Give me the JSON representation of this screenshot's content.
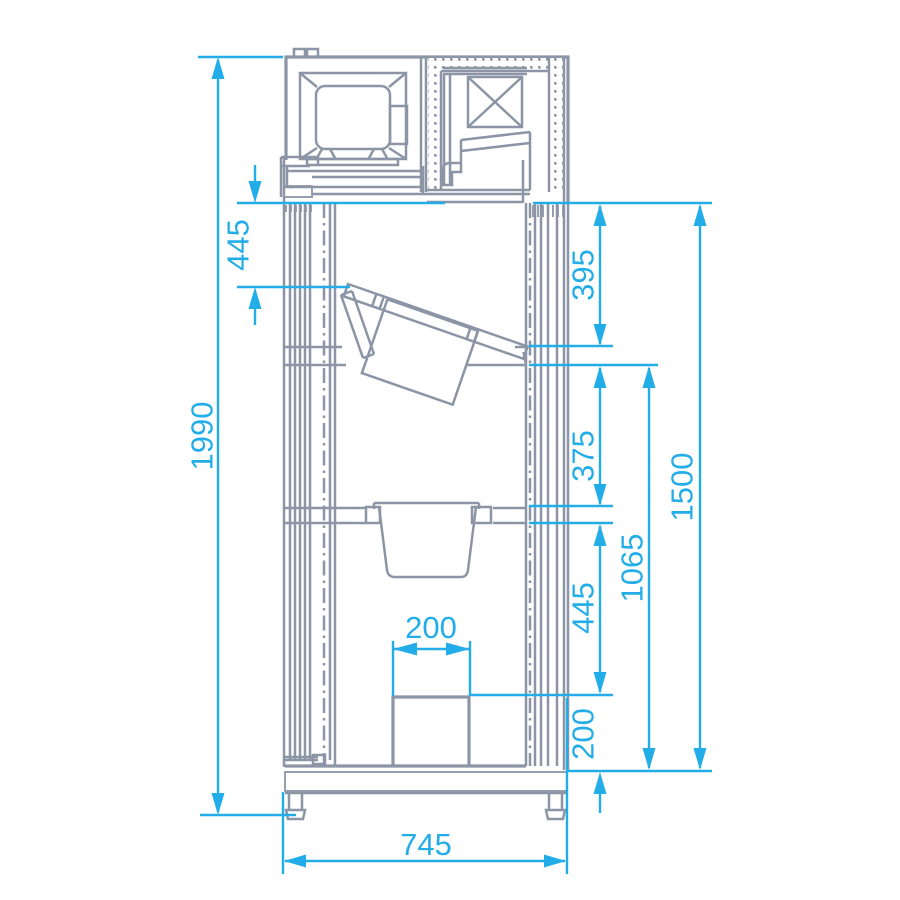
{
  "drawing": {
    "title": "refrigerated-cabinet-cross-section",
    "colors": {
      "background": "#ffffff",
      "structure_line": "#8b95a6",
      "dimension_line": "#22ade8"
    },
    "dims": {
      "overall_height": "1990",
      "top_offset_445": "445",
      "seg_395": "395",
      "seg_375": "375",
      "seg_445": "445",
      "seg_200": "200",
      "drain_width_200": "200",
      "span_1065": "1065",
      "span_1500": "1500",
      "overall_depth_745": "745"
    }
  }
}
